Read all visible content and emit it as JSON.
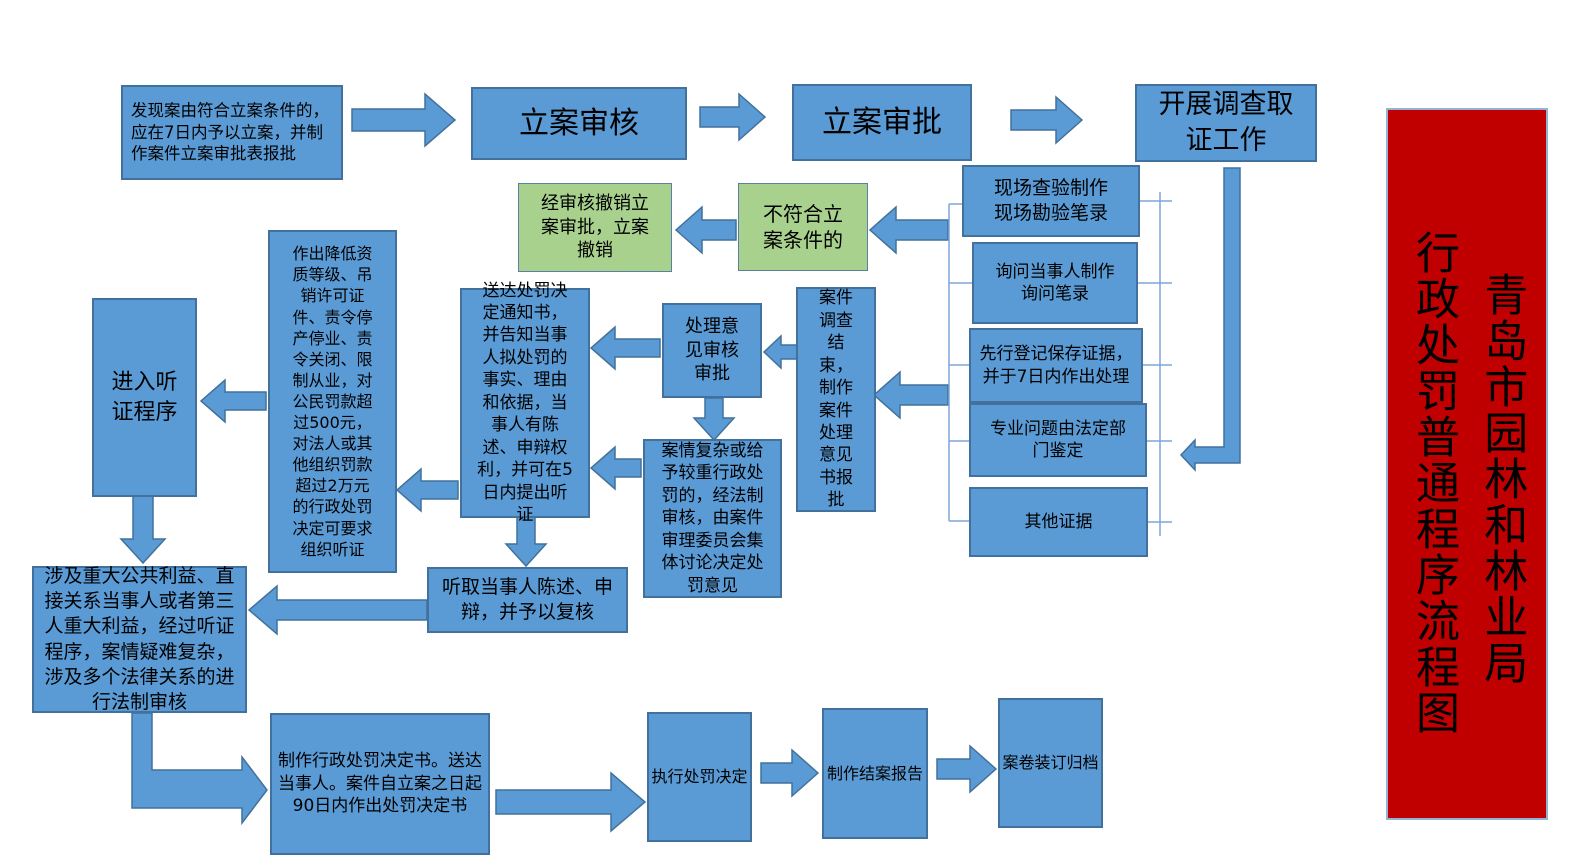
{
  "banner": {
    "org_line": "青岛市园林和林业局",
    "title_line": "行政处罚普通程序流程图",
    "background": "#C00000"
  },
  "colors": {
    "node_fill": "#5B9BD5",
    "node_border": "#41719C",
    "green_fill": "#A9D18E",
    "connector": "#7BA7D7",
    "banner_red": "#C00000"
  },
  "nodes": {
    "filing_discover": "发现案由符合立案条件的，应在7日内予以立案，并制作案件立案审批表报批",
    "filing_review": "立案审核",
    "filing_approval": "立案审批",
    "investigation": "开展调查取证工作",
    "revoke_filing": "经审核撤销立案审批，立案撤销",
    "not_meet_conditions": "不符合立案条件的",
    "site_inspection": "现场查验制作现场勘验笔录",
    "inquiry_record": "询问当事人制作询问笔录",
    "evidence_preservation": "先行登记保存证据，并于7日内作出处理",
    "expert_appraisal": "专业问题由法定部门鉴定",
    "other_evidence": "其他证据",
    "investigation_end": "案件调查结束，制作案件处理意见书报批",
    "opinion_review": "处理意见审核审批",
    "complex_case": "案情复杂或给予较重行政处罚的，经法制审核，由案件审理委员会集体讨论决定处罚意见",
    "notice_delivery": "送达处罚决定通知书，并告知当事人拟处罚的事实、理由和依据，当事人有陈述、申辩权利，并可在5日内提出听证",
    "heavy_penalty": "作出降低资质等级、吊销许可证件、责令停产停业、责令关闭、限制从业，对公民罚款超过500元，对法人或其他组织罚款超过2万元的行政处罚决定可要求组织听证",
    "hearing_procedure": "进入听证程序",
    "statement_defense": "听取当事人陈述、申辩，并予以复核",
    "legal_review": "涉及重大公共利益、直接关系当事人或者第三人重大利益，经过听证程序，案情疑难复杂，涉及多个法律关系的进行法制审核",
    "penalty_decision": "制作行政处罚决定书。送达当事人。案件自立案之日起90日内作出处罚决定书",
    "execute_penalty": "执行处罚决定",
    "closing_report": "制作结案报告",
    "archive": "案卷装订归档"
  }
}
